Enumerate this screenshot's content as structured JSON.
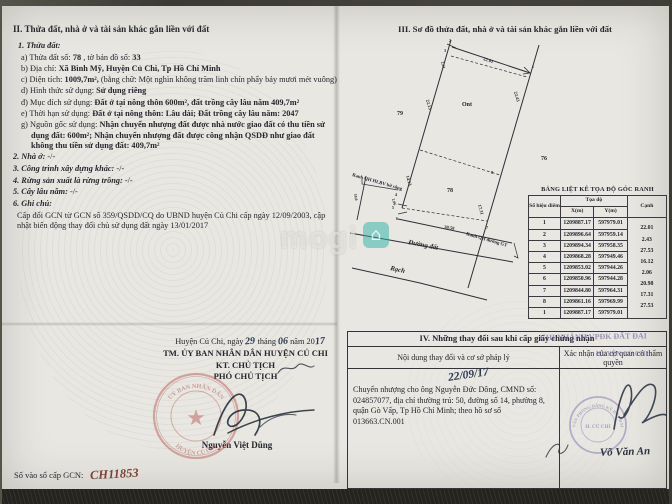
{
  "colors": {
    "paper": "#e8e7e1",
    "ink": "#26262e",
    "stamp_red": "#b5524e",
    "stamp_purple": "#7a6aa8",
    "handwriting_blue": "#2b3550",
    "register_red": "#7c4038",
    "watermark_teal": "#2bb3a6"
  },
  "watermark": {
    "text": "mogi",
    "icon": "house-icon"
  },
  "section2": {
    "heading": "II. Thửa đất, nhà ở và tài sản khác gắn liền với đất",
    "sub1": "1. Thửa đất:",
    "a_label": "a) Thửa đất số:",
    "a_value": "78",
    "a_label2": ", tờ bản đồ số:",
    "a_value2": "33",
    "b_label": "b) Địa chỉ:",
    "b_value": "Xã Bình Mỹ, Huyện Củ Chi, Tp Hồ Chí Minh",
    "c_label": "c) Diện tích:",
    "c_value": "1009,7m²,",
    "c_note": "(bằng chữ: Một nghìn không trăm linh chín phẩy bảy mươi mét vuông)",
    "d_label": "d) Hình thức sử dụng:",
    "d_value": "Sử dụng riêng",
    "dd_label": "đ) Mục đích sử dụng:",
    "dd_value": "Đất ở tại nông thôn 600m², đất trồng cây lâu năm 409,7m²",
    "e_label": "e) Thời hạn sử dụng:",
    "e_value": "Đất ở tại nông thôn: Lâu dài; Đất trồng cây lâu năm: 2047",
    "g_label": "g) Nguồn gốc sử dụng:",
    "g_value": "Nhận chuyển nhượng đất được nhà nước giao đất có thu tiền sử dụng đất: 600m²; Nhận chuyển nhượng đất được công nhận QSDĐ như giao đất không thu tiền sử dụng đất: 409,7m²",
    "i2_label": "2. Nhà ở:",
    "i2_value": "-/-",
    "i3_label": "3. Công trình xây dựng khác:",
    "i3_value": "-/-",
    "i4_label": "4. Rừng sản xuất là rừng trồng:",
    "i4_value": "-/-",
    "i5_label": "5. Cây lâu năm:",
    "i5_value": "-/-",
    "i6_label": "6. Ghi chú:",
    "note": "Cấp đổi GCN từ GCN số 359/QSDD/CQ do UBND huyện Củ Chi cấp ngày 12/09/2003, cập nhật biến động thay đổi chủ sử dụng đất ngày 13/01/2017"
  },
  "section3": {
    "heading": "III. Sơ đồ thửa đất, nhà ở và tài sản khác gắn liền với đất",
    "diagram": {
      "parcel": "78",
      "neighbor_left": "79",
      "neighbor_top": "Ont",
      "neighbor_right": "76",
      "road": "Đường đất",
      "canal": "Rạch",
      "ranh_left": "Ranh QH HLBV bờ sông",
      "ranh_right": "Ranh QH đường GT",
      "edges": {
        "top": "22.01",
        "small_top": "2.43",
        "left_upper": "22.13",
        "left_lower": "14.13",
        "right_upper": "22.43",
        "right_lower": "17.31",
        "bottom": "30.58",
        "small_left": "2.06",
        "left_width": "10.0"
      },
      "vertices": [
        "1",
        "2",
        "3",
        "4",
        "5",
        "6",
        "7",
        "8"
      ]
    },
    "coord_table": {
      "title": "BẢNG LIỆT KÊ TỌA ĐỘ GÓC RANH",
      "col_point": "Số hiệu điểm",
      "col_coord": "Tọa độ",
      "col_x": "X(m)",
      "col_y": "Y(m)",
      "col_edge": "Cạnh",
      "rows": [
        [
          "1",
          "1209887.17",
          "597979.01"
        ],
        [
          "2",
          "1209896.64",
          "597959.14"
        ],
        [
          "3",
          "1209894.34",
          "597958.35"
        ],
        [
          "4",
          "1209868.28",
          "597949.46"
        ],
        [
          "5",
          "1209853.02",
          "597944.26"
        ],
        [
          "6",
          "1209850.96",
          "597944.28"
        ],
        [
          "7",
          "1209844.80",
          "597964.31"
        ],
        [
          "8",
          "1209861.16",
          "597969.99"
        ],
        [
          "1",
          "1209887.17",
          "597979.01"
        ]
      ],
      "edges": [
        "22.01",
        "2.43",
        "27.53",
        "16.12",
        "2.06",
        "20.98",
        "17.31",
        "27.53"
      ]
    }
  },
  "section4": {
    "heading": "IV. Những thay đổi sau khi cấp giấy chứng nhận",
    "col_left": "Nội dung thay đổi và cơ sở pháp lý",
    "col_right": "Xác nhận của cơ quan có thẩm quyền",
    "hand_date": "22/09/17",
    "entry": "Chuyển nhượng cho ông Nguyễn Đức Dông, CMND số: 024857077, địa chỉ thường trú: 50, đường số 14, phường 8, quận Gò Vấp, Tp Hồ Chí Minh; theo hồ sơ số 013663.CN.001",
    "stamp_overlay_1": "CHI NHÁNH VPĐK ĐẤT ĐAI",
    "stamp_overlay_2": "HUYỆN CỦ CHI",
    "stamp": {
      "line_top": "VĂN PHÒNG ĐĂNG KÝ ĐẤT ĐAI",
      "line_center": "H. CỦ CHI"
    },
    "signer": "Võ Văn An"
  },
  "signing": {
    "place_pre": "Huyện Củ Chi, ngày",
    "d": "29",
    "m_label": "tháng",
    "m": "06",
    "y_label": "năm 20",
    "y": "17",
    "line1": "TM. ỦY BAN NHÂN DÂN HUYỆN CỦ CHI",
    "line2": "KT. CHỦ TỊCH",
    "line3": "PHÓ CHỦ TỊCH",
    "signer": "Nguyễn Việt Dũng",
    "stamp": {
      "arc_top": "UỶ BAN NHÂN DÂN",
      "arc_bottom": "HUYỆN CỦ CHI",
      "star": "★"
    },
    "register_label": "Số vào sổ cấp GCN:",
    "register_value": "CH11853"
  }
}
